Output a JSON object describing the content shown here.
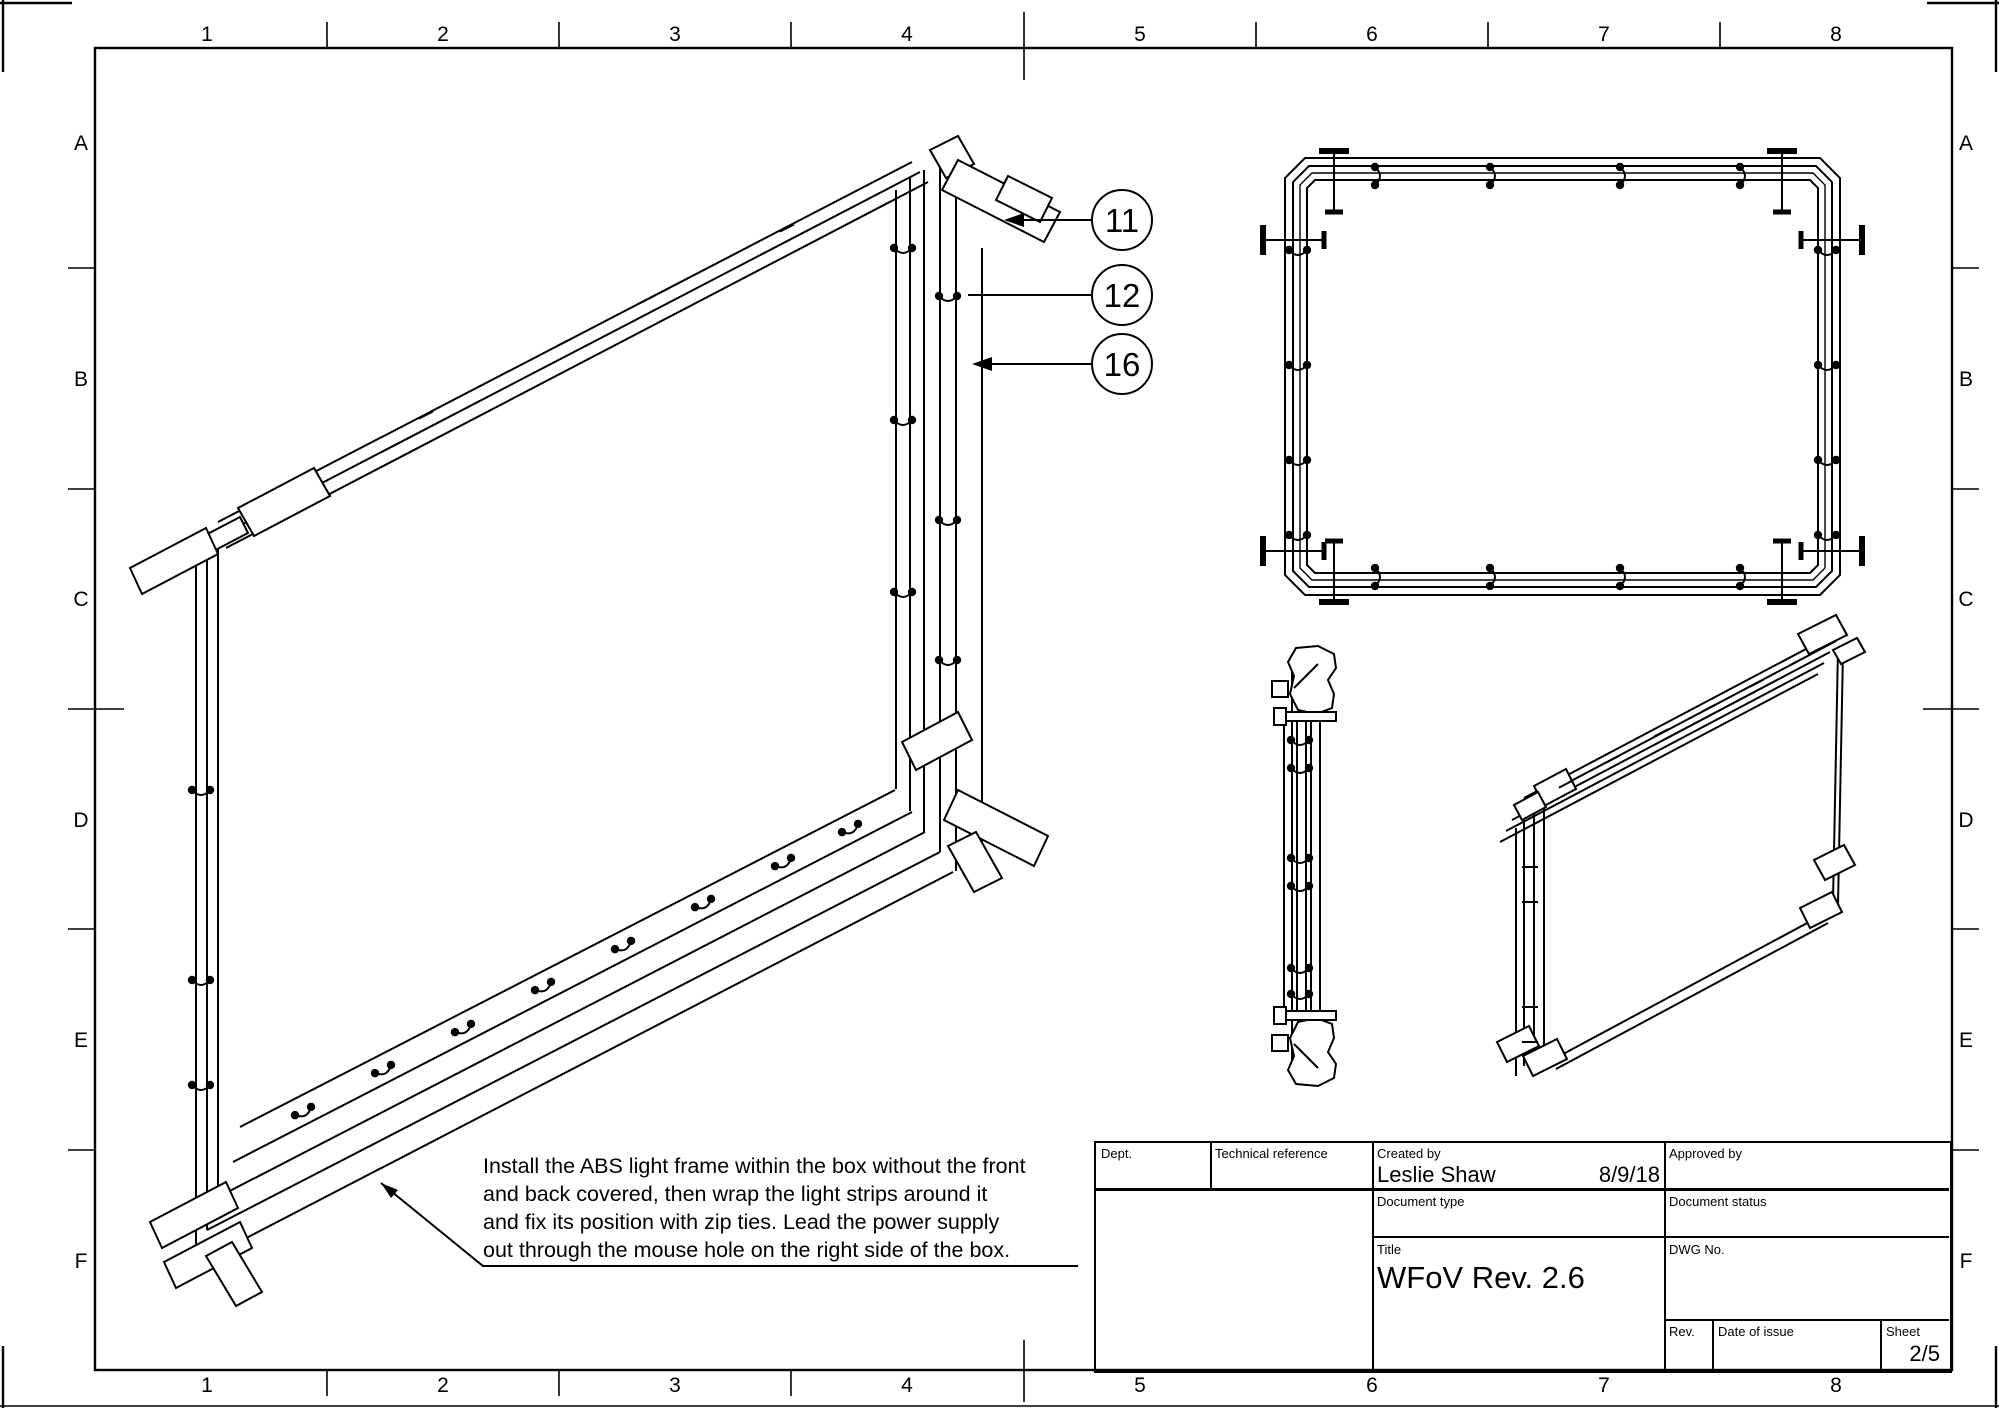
{
  "ink": "#000000",
  "paper": "#ffffff",
  "sheet_grid": {
    "columns": [
      "1",
      "2",
      "3",
      "4",
      "5",
      "6",
      "7",
      "8"
    ],
    "rows": [
      "A",
      "B",
      "C",
      "D",
      "E",
      "F"
    ]
  },
  "callouts": [
    {
      "label": "11"
    },
    {
      "label": "12"
    },
    {
      "label": "16"
    }
  ],
  "note": {
    "lines": [
      "Install the ABS light frame within the box without the front",
      "and back covered, then wrap the light strips around it",
      "and fix its position with zip ties. Lead the power supply",
      "out through the mouse hole on the right side of the box."
    ]
  },
  "title_block": {
    "dept": {
      "label": "Dept.",
      "value": ""
    },
    "technical_reference": {
      "label": "Technical reference",
      "value": ""
    },
    "created_by": {
      "label": "Created by",
      "value": "Leslie Shaw",
      "date": "8/9/18"
    },
    "approved_by": {
      "label": "Approved by",
      "value": ""
    },
    "document_type": {
      "label": "Document type",
      "value": ""
    },
    "document_status": {
      "label": "Document status",
      "value": ""
    },
    "title": {
      "label": "Title",
      "value": "WFoV Rev. 2.6"
    },
    "dwg_no": {
      "label": "DWG No.",
      "value": ""
    },
    "rev": {
      "label": "Rev.",
      "value": ""
    },
    "date_of_issue": {
      "label": "Date of issue",
      "value": ""
    },
    "sheet": {
      "label": "Sheet",
      "value": "2/5"
    }
  }
}
